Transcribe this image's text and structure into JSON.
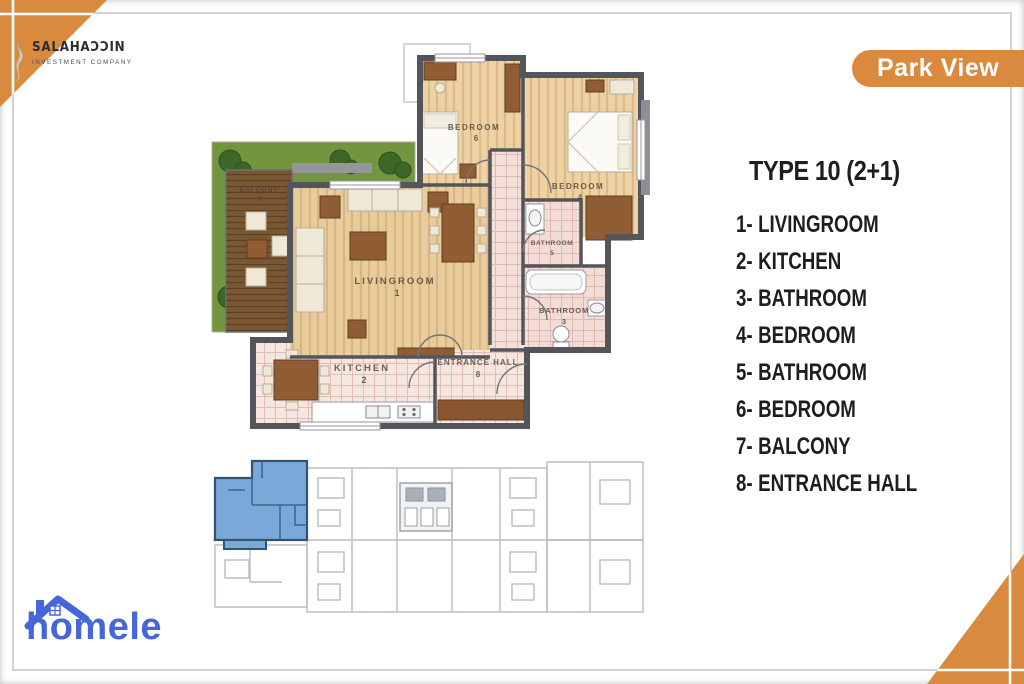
{
  "brand": {
    "company_name": "SALAHAƆƆIN",
    "company_subtitle": "INVESTMENT COMPANY",
    "project_badge": "Park View",
    "portal_logo": "homele"
  },
  "legend": {
    "title": "TYPE 10 (2+1)",
    "items": [
      {
        "num": "1-",
        "label": "LIVINGROOM"
      },
      {
        "num": "2-",
        "label": "KITCHEN"
      },
      {
        "num": "3-",
        "label": "BATHROOM"
      },
      {
        "num": "4-",
        "label": "BEDROOM"
      },
      {
        "num": "5-",
        "label": "BATHROOM"
      },
      {
        "num": "6-",
        "label": "BEDROOM"
      },
      {
        "num": "7-",
        "label": "BALCONY"
      },
      {
        "num": "8-",
        "label": "ENTRANCE HALL"
      }
    ]
  },
  "floor_plan": {
    "labels": {
      "livingroom": {
        "name": "LIVINGROOM",
        "num": "1"
      },
      "kitchen": {
        "name": "KITCHEN",
        "num": "2"
      },
      "bathroom3": {
        "name": "BATHROOM",
        "num": "3"
      },
      "bedroom4": {
        "name": "BEDROOM",
        "num": "4"
      },
      "bathroom5": {
        "name": "BATHROOM",
        "num": "5"
      },
      "bedroom6": {
        "name": "BEDROOM",
        "num": "6"
      },
      "balcony": {
        "name": "BALCONY",
        "num": "7"
      },
      "entrance_hall": {
        "name": "ENTRANCE HALL",
        "num": "8"
      }
    }
  },
  "colors": {
    "accent_orange": "#D98A3E",
    "unit_highlight_blue": "#7AA9D9",
    "portal_blue": "#4766D8",
    "wall_gray": "#55555C"
  }
}
